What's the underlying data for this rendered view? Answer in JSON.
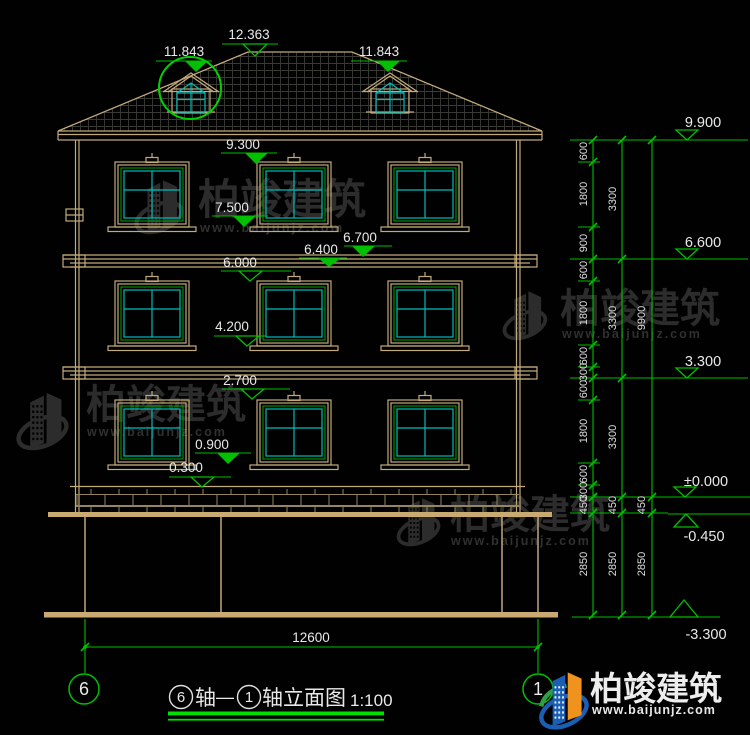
{
  "watermark": {
    "brand": "柏竣建筑",
    "site": "www.baijunjz.com"
  },
  "logo": {
    "brand": "柏竣建筑",
    "site": "www.baijunjz.com"
  },
  "title": {
    "axis_left": "6",
    "word1": "轴",
    "dash": "—",
    "axis_right": "1",
    "word2": "轴立面图",
    "scale": "1:100"
  },
  "axes": {
    "left": "6",
    "right": "1"
  },
  "dim_bottom": {
    "total": "12600"
  },
  "levels_left": [
    "12.363",
    "11.843",
    "11.843",
    "9.300",
    "7.500",
    "6.700",
    "6.400",
    "6.000",
    "4.200",
    "2.700",
    "0.900",
    "0.300"
  ],
  "levels_right": [
    "9.900",
    "6.600",
    "3.300",
    "±0.000",
    "-0.450",
    "-3.300"
  ],
  "chains": {
    "c1": [
      "600",
      "1800",
      "900",
      "600",
      "1800",
      "600",
      "300",
      "600",
      "1800",
      "600",
      "300",
      "450",
      "2850"
    ],
    "c2": [
      "3300",
      "3300",
      "3300",
      "450",
      "2850"
    ],
    "c3": [
      "9900",
      "450",
      "2850"
    ]
  },
  "colors": {
    "background": "#000000",
    "cad_tan": "#c3aa7b",
    "cad_green": "#00c000",
    "cad_cyan": "#00bcbc",
    "underline_green": "#00e000",
    "text_white": "#e9e9e9",
    "watermark_grey": "#2c2c2c",
    "logo_blue": "#1a5fb4",
    "logo_orange": "#f0921e",
    "logo_green": "#2f9e44"
  }
}
